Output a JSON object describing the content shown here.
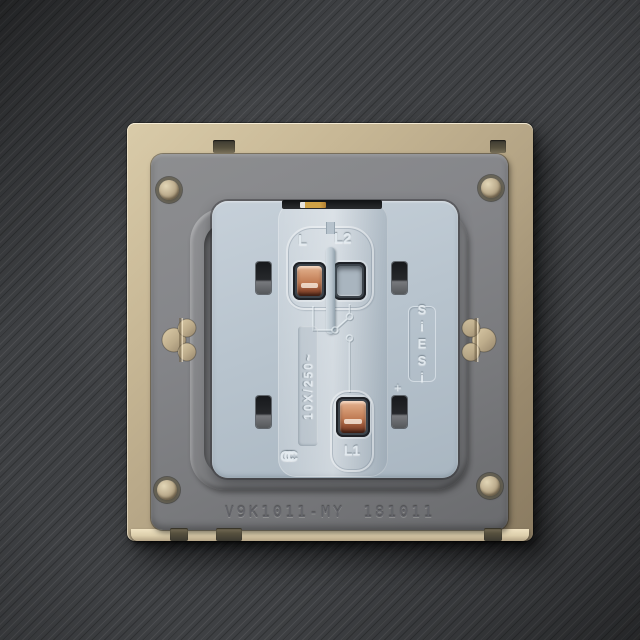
{
  "photo": {
    "subject": "rear view of a wall light-switch mechanism in a champagne metal face-plate on dark brushed metal",
    "markings": {
      "l": "L",
      "l2": "L2",
      "l1": "L1",
      "rating": "10X/250~",
      "brand": "SiESi",
      "ccc": "CCC",
      "plus": "+",
      "model": "V9K1011-MY",
      "date": "181011"
    },
    "colors": {
      "background": "#3e4043",
      "frame_champagne": "#c7b795",
      "plate_gray": "#85868a",
      "module_blue_gray": "#b8c4ce",
      "copper_terminal": "#c07b54",
      "rivet_tan": "#c0b091",
      "engraving_gray": "#63646a"
    }
  }
}
